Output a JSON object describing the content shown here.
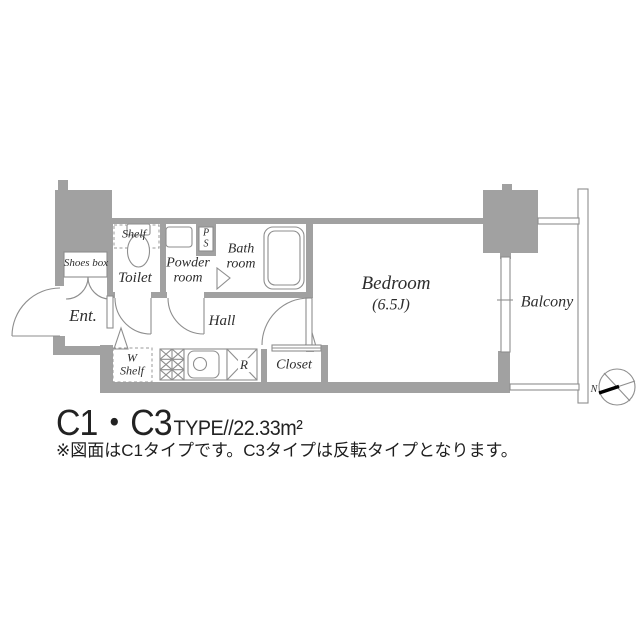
{
  "meta": {
    "kind": "apartment-floor-plan"
  },
  "colors": {
    "wall": "#a1a1a1",
    "line": "#8e8e8e",
    "text": "#2e2e2e",
    "needle": "#000000",
    "background": "#ffffff"
  },
  "plan": {
    "labels": {
      "shelf": "Shelf",
      "shoes_box": "Shoes box",
      "toilet": "Toilet",
      "powder_1": "Powder",
      "powder_2": "room",
      "ps_1": "P",
      "ps_2": "S",
      "bath_1": "Bath",
      "bath_2": "room",
      "entrance": "Ent.",
      "hall": "Hall",
      "w_shelf_1": "W",
      "w_shelf_2": "Shelf",
      "refrigerator": "R",
      "closet": "Closet",
      "bedroom": "Bedroom",
      "bedroom_area": "(6.5J)",
      "balcony": "Balcony"
    },
    "compass": {
      "north": "N"
    }
  },
  "caption": {
    "title_main": "C1・C3",
    "title_detail": "TYPE//22.33m²",
    "note": "※図面はC1タイプです。C3タイプは反転タイプとなります。"
  }
}
